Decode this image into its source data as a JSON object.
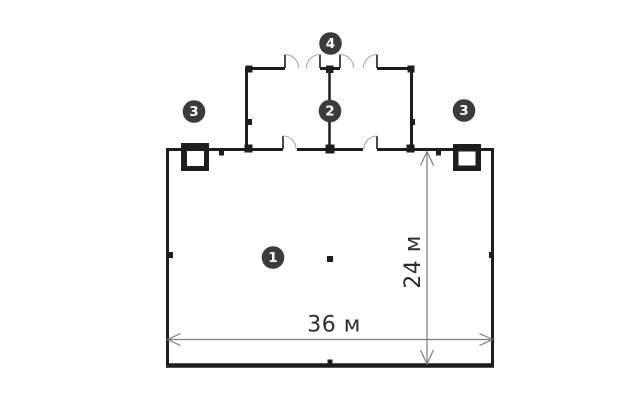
{
  "diagram": {
    "type": "floor-plan",
    "dimension_labels": {
      "width": "36 м",
      "height": "24 м"
    },
    "markers": [
      {
        "number": "1"
      },
      {
        "number": "2"
      },
      {
        "number": "3"
      },
      {
        "number": "3"
      },
      {
        "number": "4"
      }
    ],
    "colors": {
      "background": "#ffffff",
      "wall": "#1d1d1d",
      "door_arc": "#a8a8a8",
      "dimension_line": "#7d7d7d",
      "dimension_text": "#2d2d2d",
      "marker_fill": "#3b3b3b",
      "marker_text": "#ffffff"
    }
  }
}
